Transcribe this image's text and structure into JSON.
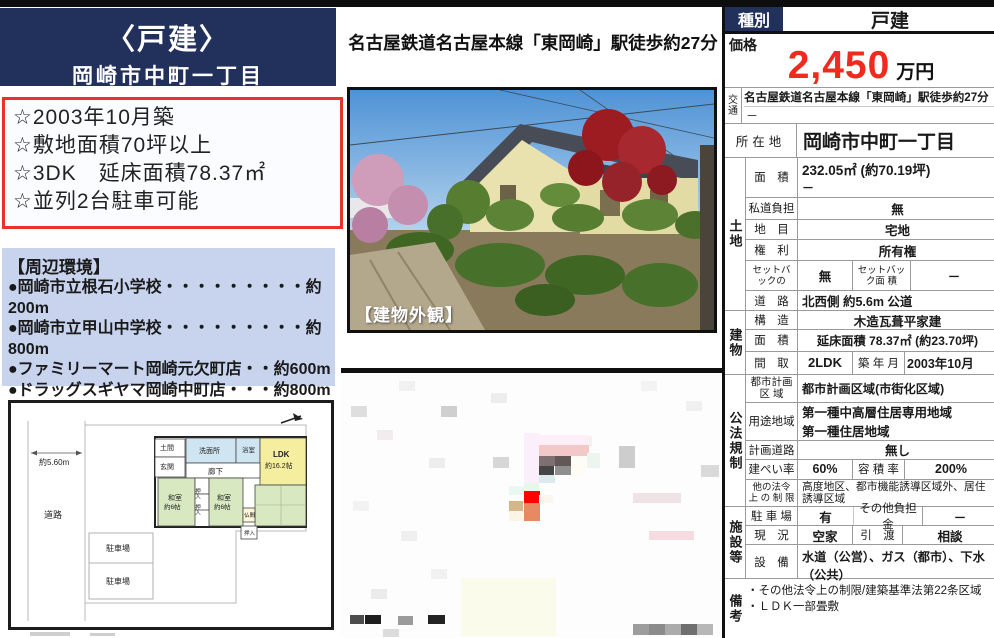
{
  "colors": {
    "navy": "#22305c",
    "highlight_border": "#e8332a",
    "env_bg": "#c8d4ee",
    "price_red": "#ee2b1c"
  },
  "left": {
    "header": {
      "type": "〈戸建〉",
      "location": "岡崎市中町一丁目"
    },
    "highlights": [
      "☆2003年10月築",
      "☆敷地面積70坪以上",
      "☆3DK　延床面積78.37㎡",
      "☆並列2台駐車可能"
    ],
    "env": {
      "title": "【周辺環境】",
      "items": [
        "●岡崎市立根石小学校・・・・・・・・・約200m",
        "●岡崎市立甲山中学校・・・・・・・・・約800m",
        "●ファミリーマート岡崎元欠町店・・約600m",
        "●ドラッグスギヤマ岡崎中町店・・・約800m",
        "●フィールKAKEMACHI店・・・・・・・・約750m"
      ]
    },
    "floorplan": {
      "road_width": "約5.60m",
      "road": "道路",
      "parking_upper": "駐車場",
      "parking_lower": "駐車場",
      "doma": "土間",
      "genkan": "玄関",
      "senmen": "洗面所",
      "bath": "浴室",
      "hall": "廊下",
      "closet_up": "押入",
      "closet_low": "押入",
      "closet_btm": "押入",
      "butsuma": "仏間",
      "washitsu_l1": "和室",
      "washitsu_l2": "約6帖",
      "washitsu_c1": "和室",
      "washitsu_c2": "約6帖",
      "ldk1": "LDK",
      "ldk2": "約16.2帖"
    }
  },
  "middle": {
    "station_line": "名古屋鉄道名古屋本線「東岡崎」駅徒歩約27分",
    "photo_caption": "【建物外観】",
    "map_cells": [
      [
        120,
        205,
        95,
        58,
        "#fbfbec"
      ],
      [
        10,
        33,
        16,
        11,
        "#dedede"
      ],
      [
        100,
        33,
        16,
        11,
        "#cfcfcf"
      ],
      [
        58,
        8,
        16,
        10,
        "#f1f1f1"
      ],
      [
        150,
        20,
        16,
        10,
        "#ededed"
      ],
      [
        36,
        57,
        16,
        10,
        "#f3ecec"
      ],
      [
        88,
        85,
        16,
        10,
        "#ededed"
      ],
      [
        152,
        84,
        16,
        11,
        "#d7d7d7"
      ],
      [
        278,
        73,
        16,
        22,
        "#cdcdcd"
      ],
      [
        360,
        92,
        18,
        12,
        "#dadada"
      ],
      [
        12,
        128,
        16,
        10,
        "#f2f2f2"
      ],
      [
        60,
        158,
        16,
        10,
        "#efefef"
      ],
      [
        90,
        196,
        16,
        10,
        "#f1f1f1"
      ],
      [
        30,
        216,
        16,
        10,
        "#ebebeb"
      ],
      [
        235,
        63,
        16,
        10,
        "#f4f0f0"
      ],
      [
        345,
        28,
        16,
        10,
        "#f0f0f0"
      ],
      [
        300,
        8,
        16,
        10,
        "#f3f3f3"
      ],
      [
        183,
        60,
        16,
        50,
        "#fbeffb"
      ],
      [
        198,
        62,
        50,
        10,
        "#fdeef7"
      ],
      [
        198,
        72,
        50,
        11,
        "#f3c8c8"
      ],
      [
        198,
        83,
        16,
        10,
        "#7e7070"
      ],
      [
        214,
        83,
        16,
        10,
        "#635858"
      ],
      [
        198,
        93,
        15,
        9,
        "#454545"
      ],
      [
        214,
        93,
        16,
        9,
        "#8f8f8f"
      ],
      [
        198,
        102,
        16,
        8,
        "#dceaec"
      ],
      [
        230,
        83,
        14,
        20,
        "#fdfdf6"
      ],
      [
        246,
        80,
        13,
        15,
        "#eef5ee"
      ],
      [
        168,
        113,
        15,
        9,
        "#e9f8f1"
      ],
      [
        183,
        110,
        15,
        8,
        "#e8f8e8"
      ],
      [
        183,
        118,
        16,
        12,
        "#fd0404"
      ],
      [
        168,
        128,
        14,
        10,
        "#d3b78b"
      ],
      [
        183,
        130,
        16,
        18,
        "#e78a63"
      ],
      [
        168,
        138,
        14,
        10,
        "#fcf4e4"
      ],
      [
        198,
        122,
        14,
        8,
        "#fbf6ed"
      ],
      [
        292,
        120,
        48,
        10,
        "#efe3e3"
      ],
      [
        308,
        158,
        45,
        9,
        "#f7dbe3"
      ],
      [
        9,
        242,
        14,
        9,
        "#4c4c4c"
      ],
      [
        24,
        242,
        16,
        9,
        "#1e1e1e"
      ],
      [
        57,
        243,
        15,
        9,
        "#9b9b9b"
      ],
      [
        87,
        242,
        17,
        9,
        "#232323"
      ],
      [
        42,
        256,
        16,
        8,
        "#dcdcdc"
      ],
      [
        292,
        251,
        16,
        11,
        "#9d9d9d"
      ],
      [
        308,
        251,
        16,
        11,
        "#8b8b8b"
      ],
      [
        324,
        251,
        16,
        11,
        "#ababab"
      ],
      [
        340,
        251,
        16,
        11,
        "#6f6f6f"
      ],
      [
        356,
        251,
        16,
        11,
        "#b7b7b7"
      ]
    ]
  },
  "table": {
    "header": {
      "label": "種別",
      "value": "戸建"
    },
    "price": {
      "label": "価格",
      "value": "2,450",
      "unit": "万円"
    },
    "access": {
      "label": "交通",
      "line1": "名古屋鉄道名古屋本線「東岡崎」駅徒歩約27分",
      "line2": "－"
    },
    "address": {
      "label": "所在地",
      "value": "岡崎市中町一丁目"
    },
    "land": {
      "group": "土地",
      "area_label": "面　積",
      "area1": "232.05㎡ (約70.19坪)",
      "area2": "－",
      "shido_label": "私道負担",
      "shido": "無",
      "chimoku_label": "地　目",
      "chimoku": "宅地",
      "kenri_label": "権　利",
      "kenri": "所有権",
      "setback_label": "セットバックの",
      "setback": "無",
      "setback_area_label": "セットバック面 積",
      "setback_area": "－",
      "road_label": "道　路",
      "road": "北西側 約5.6m 公道"
    },
    "building": {
      "group": "建物",
      "kouzou_label": "構　造",
      "kouzou": "木造瓦葺平家建",
      "area_label": "面　積",
      "area": "延床面積 78.37㎡ (約23.70坪)",
      "madori_label": "間　取",
      "madori": "2LDK",
      "chikunen_label": "築 年 月",
      "chikunen": "2003年10月"
    },
    "regulation": {
      "group": "公法規制",
      "toshi_label": "都市計画区 域",
      "toshi": "都市計画区域(市街化区域)",
      "youto_label": "用途地域",
      "youto1": "第一種中高層住居専用地域",
      "youto2": "第一種住居地域",
      "keikaku_label": "計画道路",
      "keikaku": "無し",
      "kenpei_label": "建ぺい率",
      "kenpei": "60%",
      "youseki_label": "容 積 率",
      "youseki": "200%",
      "hoka_label": "他の法令上 の 制 限",
      "hoka": "高度地区、都市機能誘導区域外、居住誘導区域"
    },
    "facility": {
      "group": "施設等",
      "parking_label": "駐 車 場",
      "parking": "有",
      "futan_label": "その他負担金",
      "futan": "－",
      "genkyo_label": "現　況",
      "genkyo": "空家",
      "hikiwatashi_label": "引　渡",
      "hikiwatashi": "相談",
      "setsubi_label": "設　備",
      "setsubi": "水道（公営）、ガス（都市）、下水（公共）"
    },
    "remarks": {
      "group": "備考",
      "line1": "・その他法令上の制限/建築基準法第22条区域",
      "line2": "・ＬＤＫ一部畳敷"
    }
  }
}
